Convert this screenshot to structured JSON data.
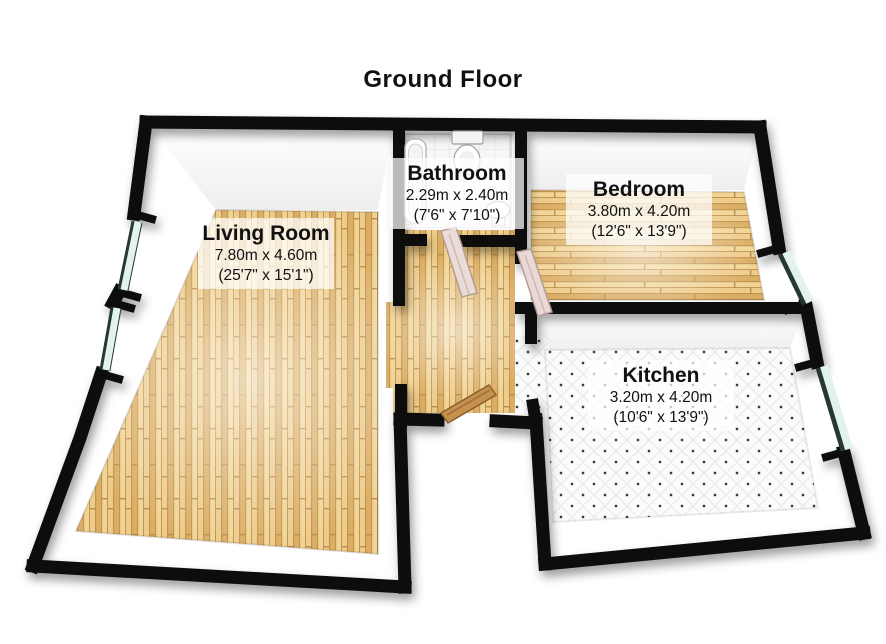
{
  "title": "Ground Floor",
  "rooms": {
    "living": {
      "name": "Living Room",
      "metric": "7.80m x 4.60m",
      "imperial": "(25'7\" x 15'1\")"
    },
    "bathroom": {
      "name": "Bathroom",
      "metric": "2.29m x 2.40m",
      "imperial": "(7'6\" x 7'10\")"
    },
    "bedroom": {
      "name": "Bedroom",
      "metric": "3.80m x 4.20m",
      "imperial": "(12'6\" x 13'9\")"
    },
    "kitchen": {
      "name": "Kitchen",
      "metric": "3.20m x 4.20m",
      "imperial": "(10'6\" x 13'9\")"
    }
  },
  "colors": {
    "wall": "#0c0c0c",
    "wood_floor": "#e6bd77",
    "tile_floor": "#f7f7f7",
    "kitchen_floor": "#fafafa",
    "window_glass": "#dff0ea",
    "door_wood": "#c6914f",
    "door_interior": "#ecdcd7",
    "label_bg": "rgba(255,255,255,0.72)",
    "text": "#111111"
  },
  "fixtures": [
    "bathtub",
    "toilet",
    "sink",
    "bathroom-door",
    "bedroom-door",
    "entrance-door",
    "window-left-upper",
    "window-left-lower",
    "window-bedroom",
    "window-kitchen"
  ]
}
